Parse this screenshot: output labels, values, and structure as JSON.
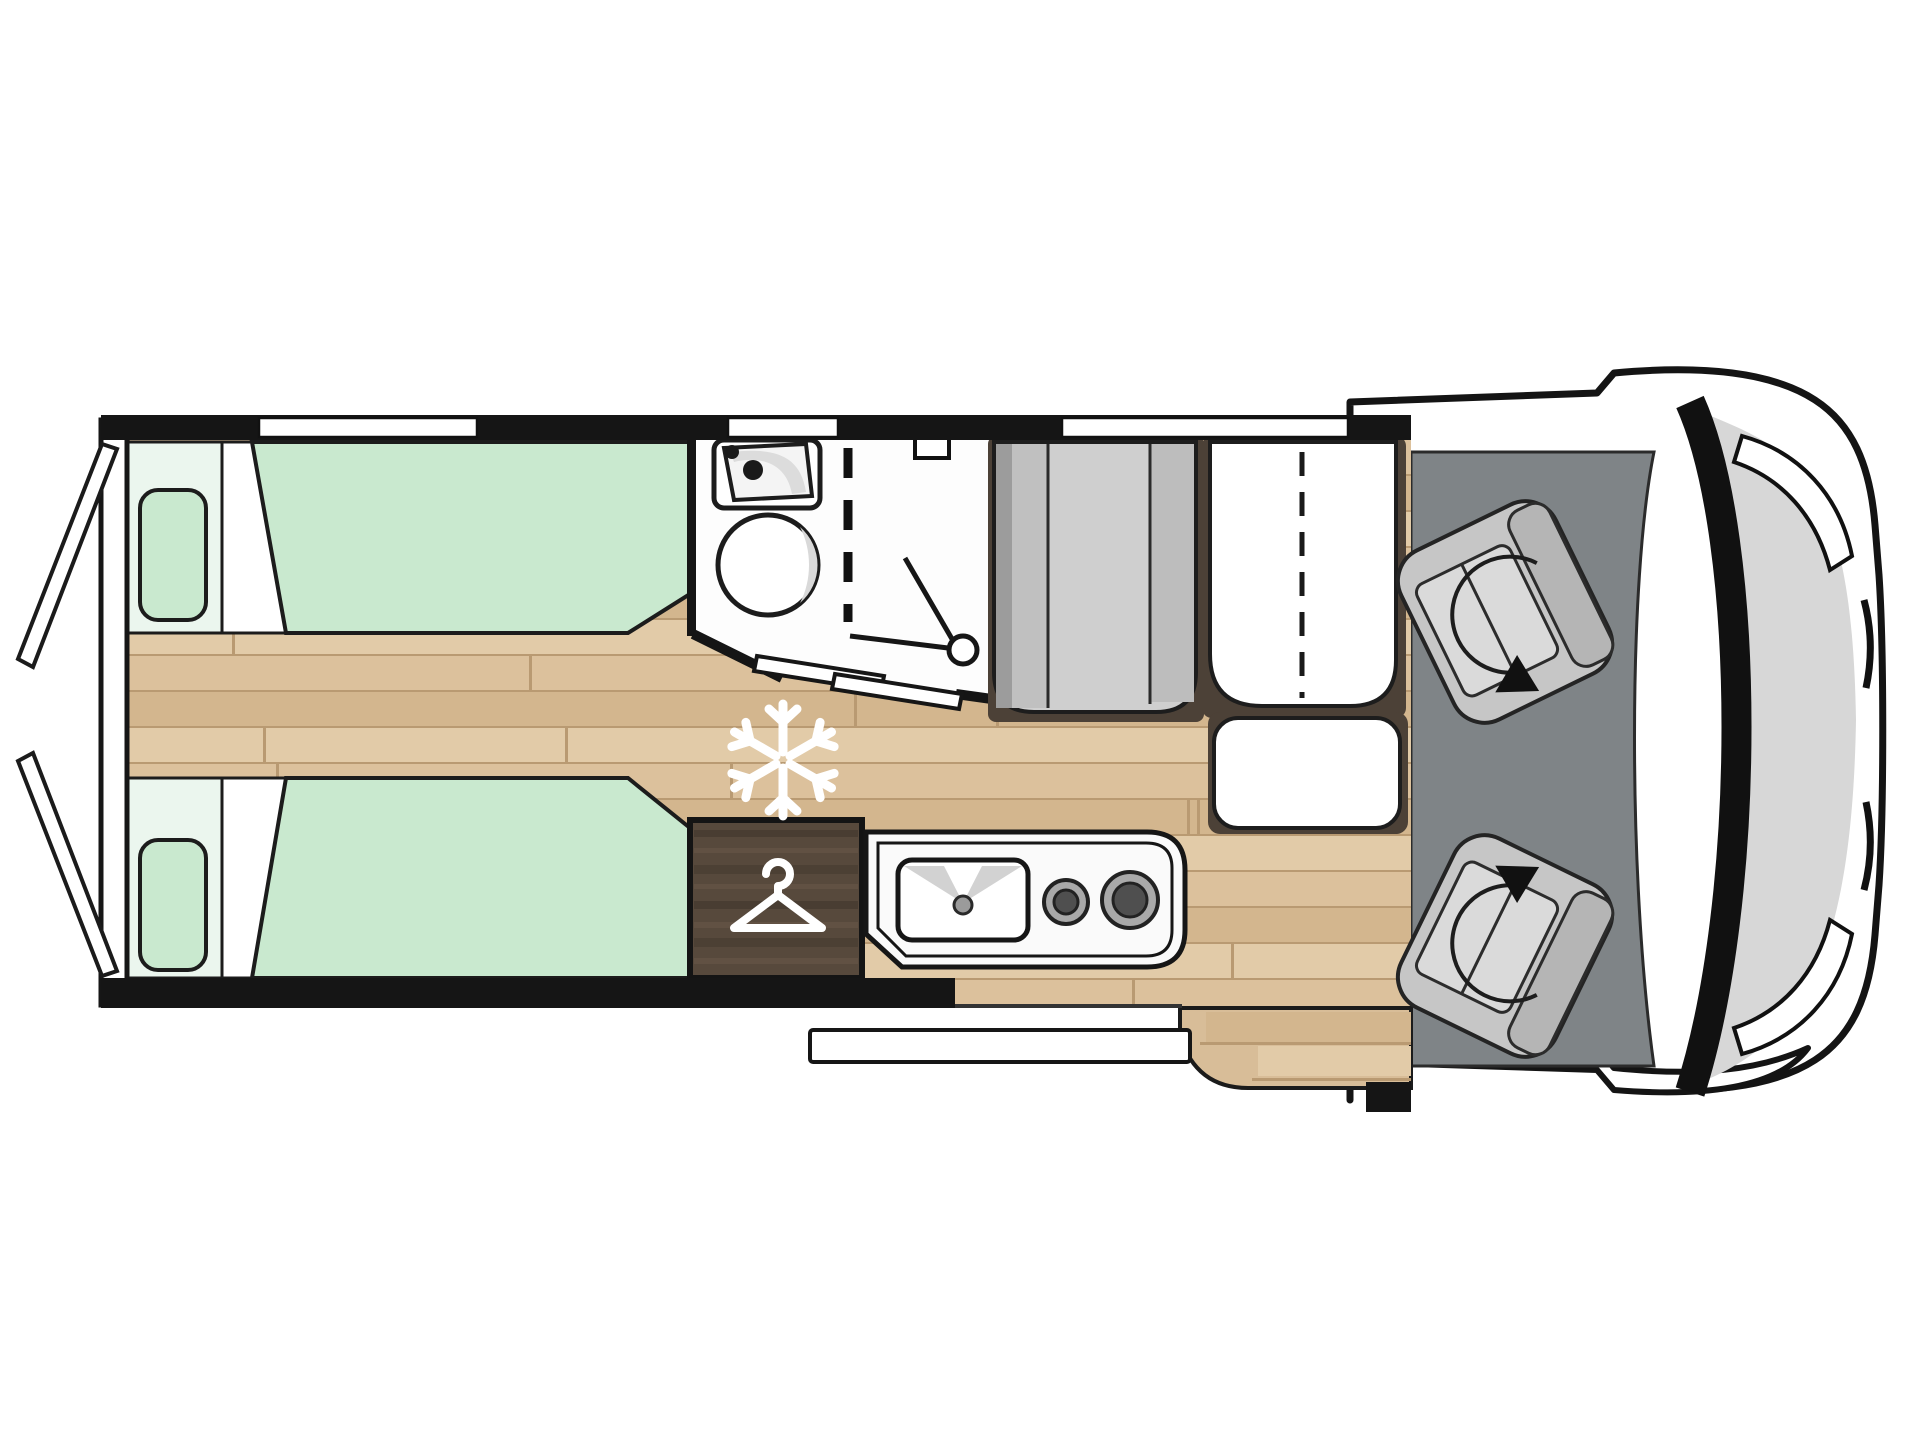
{
  "diagram": {
    "kind": "motorhome-floorplan-top-view",
    "orientation": "vehicle front at right, rear doors open at left"
  },
  "counts": {
    "single_beds": 2,
    "pillows": 2,
    "cab_swivel_seats": 2,
    "hob_burners": 2,
    "wall_windows": 3,
    "rear_doors": 2
  },
  "icons": {
    "snowflake": "snowflake-icon (fridge/freezer position)",
    "hanger": "clothes-hanger-icon (wardrobe)",
    "swivel_arrow": "rotating-seat-arrow-icon",
    "shower": "shower-head-icon"
  },
  "colors": {
    "wall": "#151515",
    "body": "#ffffff",
    "hood": "#d7d7d7",
    "cab_floor": "#7f8487",
    "seat": "#c6c6c6",
    "seat_cushion": "#dadada",
    "seat_back": "#b5b5b5",
    "mattress": "#c9e9cf",
    "headboard": "#ebf6ee",
    "floor": "#d8bd98",
    "plank_a": "#dcc19c",
    "plank_b": "#d3b68e",
    "plank_c": "#e2cba8",
    "seam": "#b99a72",
    "wardrobe": "#57493c",
    "bench_gray": "#cfcfcf",
    "trim": "#4c4137",
    "white_fixture": "#fdfdfd"
  }
}
